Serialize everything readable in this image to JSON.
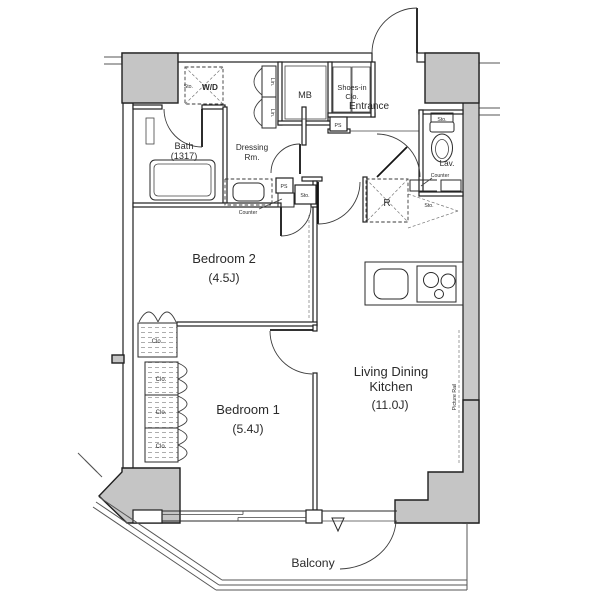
{
  "title": "Apartment floor plan (2 bedrooms + LDK)",
  "colors": {
    "background": "#ffffff",
    "wall_line": "#1f1f1f",
    "pillar_fill": "#c5c5c5",
    "outer_band_fill": "#c9c9c9",
    "text": "#2b2b2b"
  },
  "rooms": {
    "bath": {
      "name": "Bath",
      "size": "(1317)"
    },
    "dressing": {
      "line1": "Dressing",
      "line2": "Rm."
    },
    "bedroom2": {
      "name": "Bedroom 2",
      "size": "(4.5J)"
    },
    "bedroom1": {
      "name": "Bedroom 1",
      "size": "(5.4J)"
    },
    "ldk": {
      "line1": "Living Dining",
      "line2": "Kitchen",
      "size": "(11.0J)"
    },
    "entrance": {
      "name": "Entrance"
    },
    "lav": {
      "name": "Lav."
    },
    "mb": {
      "name": "MB"
    },
    "shoes": {
      "line1": "Shoes-in",
      "line2": "Clo."
    },
    "balcony": {
      "name": "Balcony"
    }
  },
  "labels": {
    "wd": "W/D",
    "sto": "Sto.",
    "lin": "Lin.",
    "ps": "PS",
    "counter": "Counter",
    "clo": "Clo.",
    "refrigerator": "R",
    "picture_rail": "Picture Rail"
  }
}
